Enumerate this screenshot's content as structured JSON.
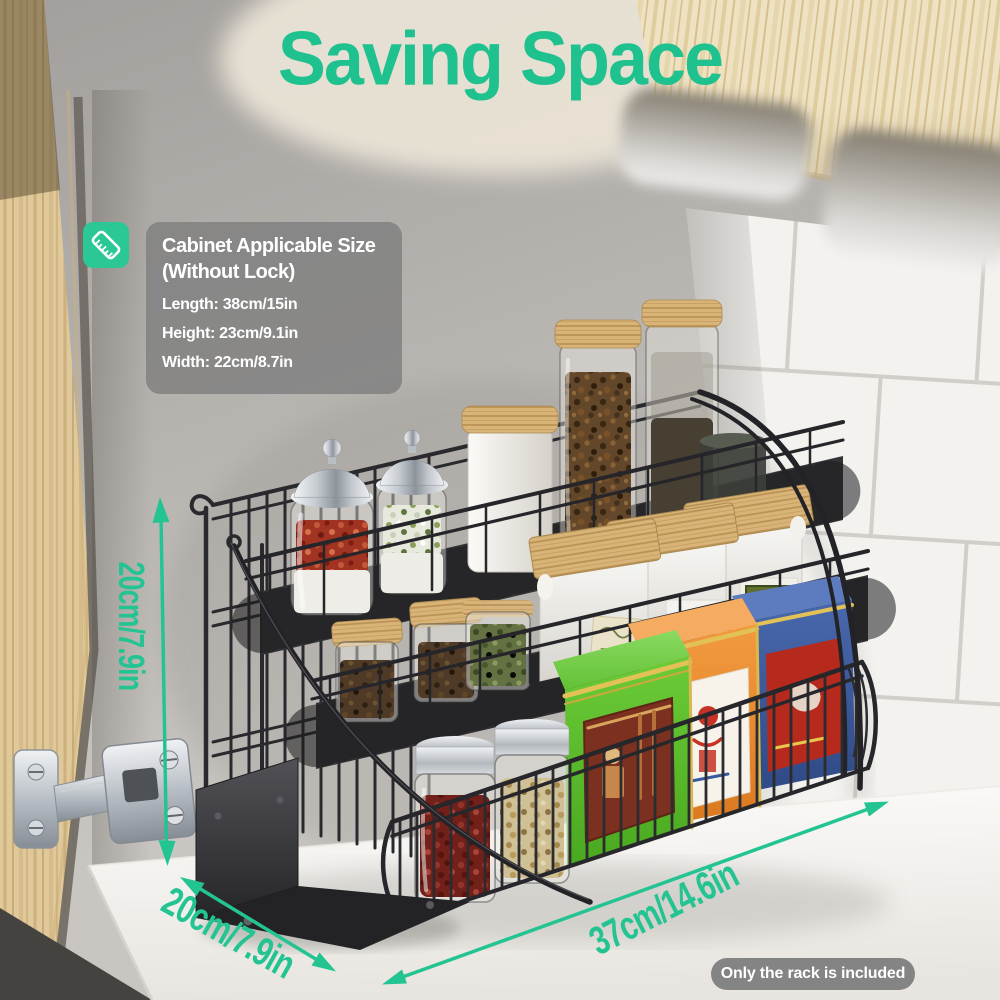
{
  "title": "Saving Space",
  "info_panel": {
    "icon": "ruler-icon",
    "heading_line1": "Cabinet Applicable Size",
    "heading_line2": "(Without Lock)",
    "specs": [
      "Length: 38cm/15in",
      "Height: 23cm/9.1in",
      "Width: 22cm/8.7in"
    ]
  },
  "dimension_labels": {
    "height": "20cm/7.9in",
    "depth": "20cm/7.9in",
    "width": "37cm/14.6in"
  },
  "footnote_badge": "Only the rack is included",
  "colors": {
    "accent_green": "#23C492",
    "title_green": "#1FC28E",
    "icon_bg_green": "#2BC795",
    "panel_bg_gray": "#7F7F7F",
    "badge_bg_gray": "#767676"
  }
}
